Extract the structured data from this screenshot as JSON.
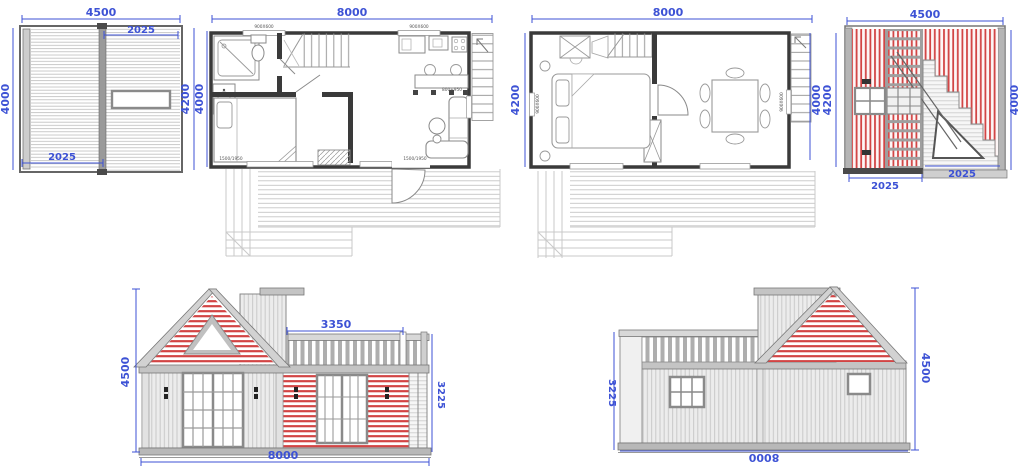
{
  "colors": {
    "dimension_blue": "#3d52d5",
    "wall_dark": "#3a3a3a",
    "line_gray": "#8a8a8a",
    "hatch_red": "#d24444",
    "siding_light": "#ebebeb",
    "roof_gray": "#c8c8c8"
  },
  "roof_plan": {
    "dims": {
      "top": "4500",
      "top_right": "2025",
      "left": "4000",
      "bottom_left": "2025",
      "right_outer": "4200",
      "right_inner": "4000"
    }
  },
  "floor_plan_1": {
    "dims": {
      "top": "8000"
    },
    "labels": {
      "window_top_left": "900X600",
      "window_top_right": "900X600",
      "window_bottom_left": "1500/1950",
      "window_bottom_right": "1500/1950",
      "door_right": "800+950"
    }
  },
  "floor_plan_2": {
    "dims": {
      "top": "8000",
      "left": "4200",
      "right_inner": "4000",
      "right_outer": "4200"
    },
    "labels": {
      "window_left": "900X600",
      "window_right": "900X600"
    }
  },
  "stair_section": {
    "dims": {
      "top": "4500",
      "right": "4000",
      "bottom_left": "2025",
      "bottom_mid": "2025"
    }
  },
  "front_elevation": {
    "dims": {
      "left": "4500",
      "balcony": "3350",
      "right": "3225",
      "bottom": "8000"
    }
  },
  "rear_elevation": {
    "dims": {
      "left": "3225",
      "right": "4500",
      "bottom": "8000"
    }
  }
}
